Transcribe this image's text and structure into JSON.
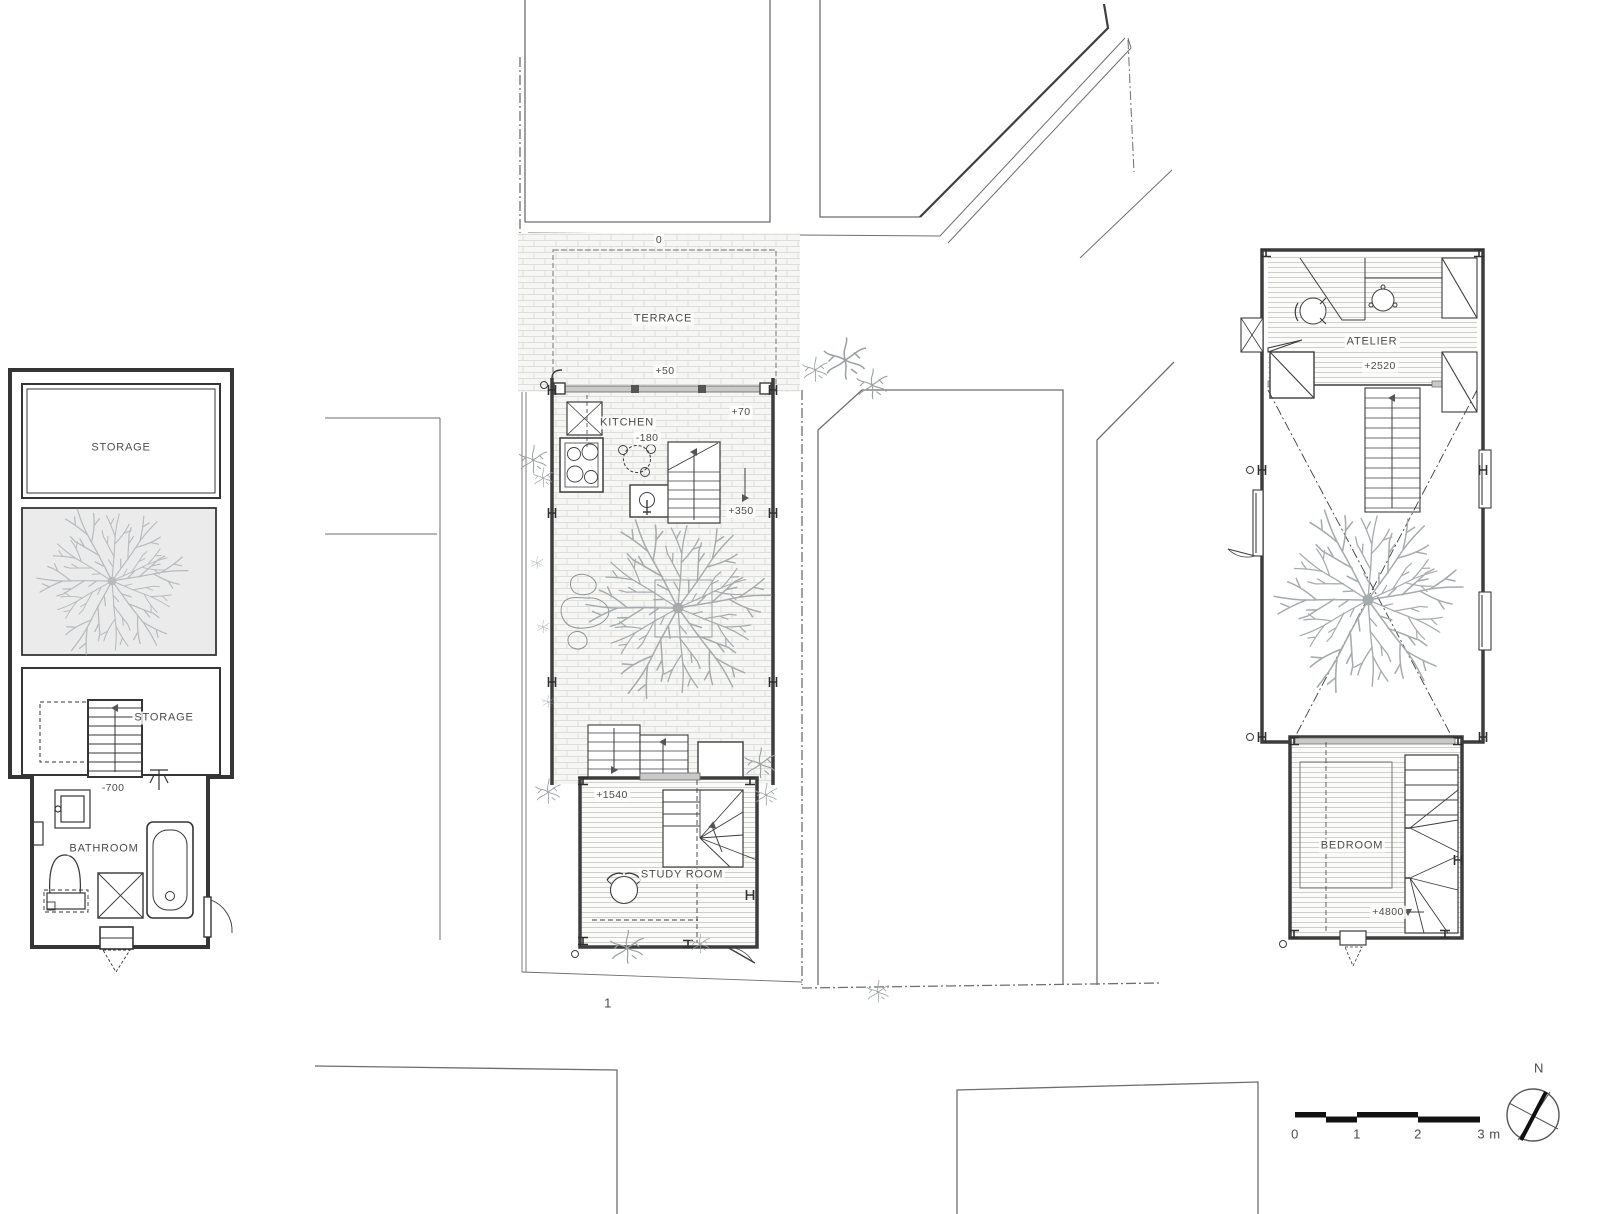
{
  "sheet": {
    "type": "architectural-floor-plans",
    "road_label": "1",
    "north_label": "N",
    "scale_bar": {
      "tick_0": "0",
      "tick_1": "1",
      "tick_2": "2",
      "tick_3": "3 m"
    },
    "colors": {
      "wall": "#3d3d3d",
      "site_line": "#6e6e6e",
      "hatch": "#d9d9d6",
      "tree": "#a6abae",
      "glazing_fill": "#c9c9c9",
      "tree_box_fill": "#ebebeb"
    }
  },
  "basement_plan": {
    "storage_upper": "STORAGE",
    "storage_lower": "STORAGE",
    "stair_level": "-700",
    "bathroom": "BATHROOM"
  },
  "ground_plan": {
    "sidewalk_level": "0",
    "terrace": "TERRACE",
    "terrace_level": "+50",
    "kitchen": "KITCHEN",
    "kitchen_level": "-180",
    "court_level": "+70",
    "landing_level": "+350",
    "study_entry_level": "+1540",
    "study_room": "STUDY ROOM"
  },
  "upper_plan": {
    "atelier": "ATELIER",
    "atelier_level": "+2520",
    "bedroom": "BEDROOM",
    "bedroom_level": "+4800"
  }
}
